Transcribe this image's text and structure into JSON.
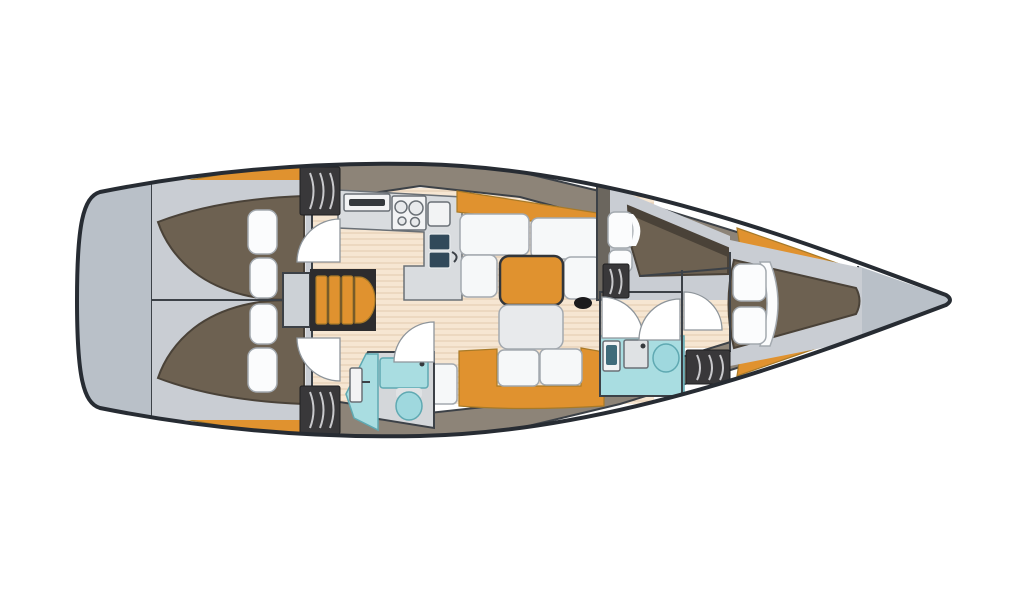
{
  "colors": {
    "page_bg": "#ffffff",
    "hull_outline": "#272c33",
    "hull_fill": "#ffffff",
    "panel_gray": "#b9c0c8",
    "cabin_gray": "#c9cdd3",
    "sheet_gray": "#e2e4e7",
    "taupe_band": "#8d8478",
    "bulkhead_taupe": "#6b665e",
    "deck_orange": "#e0922f",
    "bed_brown": "#6d6151",
    "bed_shadow": "#4a4238",
    "pillow_white": "#fbfcfd",
    "cushion_white": "#f6f8f9",
    "floor_beige": "#f6e6d2",
    "floor_stripe": "#e3c9ad",
    "counter_gray": "#d9dcdf",
    "appliance_white": "#f2f3f4",
    "panel_slot": "#35393d",
    "burner_gray": "#e8eaec",
    "sink_navy": "#31495a",
    "steps_frame": "#2d2c2e",
    "landing_gray": "#ccd1d6",
    "teal": "#a9dde1",
    "toilet_teal": "#9fd8de",
    "fixture_gray": "#dfe2e4",
    "basin_navy": "#3f6b7a",
    "locker_dark": "#39383a",
    "door_white": "#ffffff",
    "table_leaf_gray": "#e8eaec",
    "black_detail": "#1b1b1d",
    "head_floor_gray": "#d4d7da"
  }
}
